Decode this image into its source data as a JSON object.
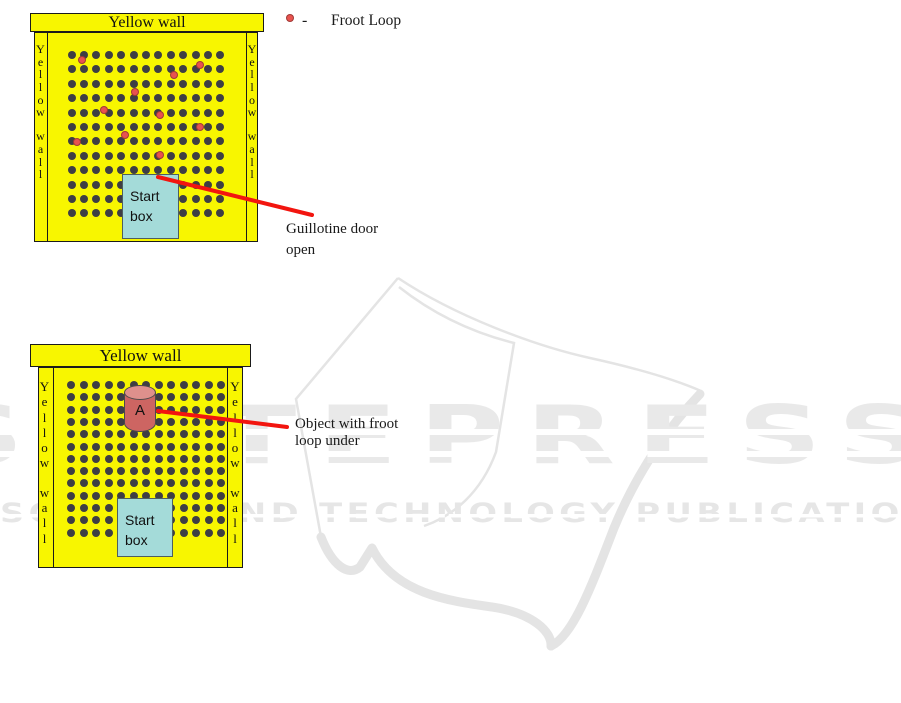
{
  "legend": {
    "dash": "-",
    "label": "Froot Loop"
  },
  "arena_top": {
    "header": "Yellow wall",
    "side_wall_text": "Yellow wall",
    "grid": {
      "cols": 13,
      "rows": 12,
      "x0": 71.5,
      "y0": 55,
      "dx": 12.4,
      "dy": 14.4,
      "dot_size": 8
    },
    "froot_loops": [
      [
        85,
        63
      ],
      [
        203,
        68
      ],
      [
        177,
        78
      ],
      [
        138,
        95
      ],
      [
        107,
        113
      ],
      [
        163,
        118
      ],
      [
        203,
        130
      ],
      [
        128,
        138
      ],
      [
        80,
        145
      ],
      [
        163,
        158
      ]
    ],
    "start_box_label": [
      "Start",
      "box"
    ],
    "annotation": [
      "Guillotine door",
      "open"
    ],
    "pointer": {
      "x1": 158,
      "y1": 177,
      "x2": 312,
      "y2": 215
    }
  },
  "arena_bottom": {
    "header": "Yellow wall",
    "side_wall_text": "Yellow wall",
    "grid": {
      "cols": 13,
      "rows": 13,
      "x0": 71,
      "y0": 385,
      "dx": 12.5,
      "dy": 12.3,
      "dot_size": 8
    },
    "froot_loops": [],
    "cylinder_label": "A",
    "start_box_label": [
      "Start",
      "box"
    ],
    "annotation": [
      "Object with froot",
      "loop under"
    ],
    "pointer": {
      "x1": 158,
      "y1": 411,
      "x2": 287,
      "y2": 427
    }
  },
  "watermark": {
    "word": "SCITEPRESS",
    "tagline": "SCIENCE AND TECHNOLOGY PUBLICATIONS"
  },
  "colors": {
    "wall_yellow": "#f8f600",
    "hole_dot": "#3e3e44",
    "start_box": "#a4dbd9",
    "froot_loop_ring": "#e8534f",
    "pointer_line": "#f2150f",
    "cylinder_body": "#cd6562",
    "cylinder_top": "#de908c",
    "watermark_gray": "#e9e9e9"
  }
}
